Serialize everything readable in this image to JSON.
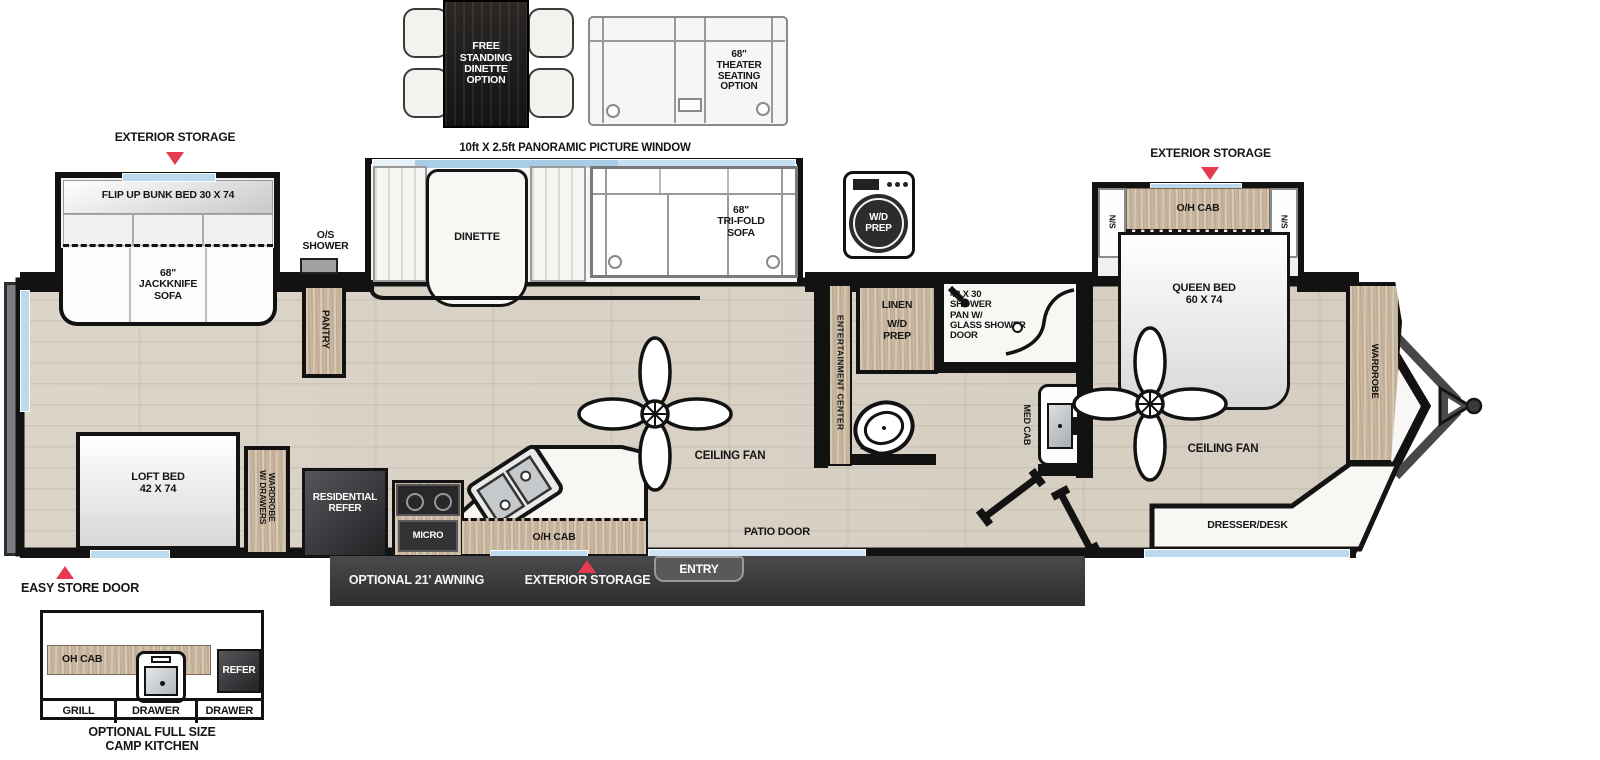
{
  "colors": {
    "accent_red": "#e63a50",
    "wall_black": "#121212",
    "window_blue": "#bcd9ee",
    "awning_bar": "#3c3c3f",
    "floor_wood": "#d9d2c5",
    "cabinet_wood": "#c8b59d"
  },
  "icons": {
    "washer": "washer-icon",
    "callout_marker": "triangle-marker",
    "fan": "ceiling-fan-icon",
    "hitch": "trailer-hitch-icon"
  },
  "top_options": {
    "dinette_label": "FREE\nSTANDING\nDINETTE\nOPTION",
    "theater_label": "68\"\nTHEATER\nSEATING\nOPTION",
    "window_label": "10ft X 2.5ft PANORAMIC PICTURE WINDOW",
    "washer_label": "W/D\nPREP"
  },
  "callouts": {
    "rear_storage": "EXTERIOR STORAGE",
    "front_storage": "EXTERIOR STORAGE",
    "bottom_storage": "EXTERIOR STORAGE",
    "easy_store": "EASY STORE DOOR",
    "awning": "OPTIONAL 21' AWNING",
    "entry": "ENTRY",
    "patio": "PATIO DOOR",
    "os_shower": "O/S\nSHOWER"
  },
  "living": {
    "bunk": "FLIP UP BUNK BED 30 X 74",
    "jackknife": "68\"\nJACKKNIFE\nSOFA",
    "dinette": "DINETTE",
    "trifold": "68\"\nTRI-FOLD\nSOFA",
    "pantry": "PANTRY",
    "fan": "CEILING FAN",
    "ent_center": "ENTERTAINMENT CENTER"
  },
  "kitchen": {
    "refer": "RESIDENTIAL\nREFER",
    "micro": "MICRO",
    "ohcab": "O/H CAB"
  },
  "bath": {
    "linen": "LINEN",
    "wd": "W/D\nPREP",
    "shower": "48 X 30\nSHOWER\nPAN W/\nGLASS SHOWER\nDOOR",
    "medcab": "MED CAB"
  },
  "bedroom": {
    "ohcab": "O/H CAB",
    "ns_l": "N/S",
    "ns_r": "N/S",
    "bed": "QUEEN BED\n60 X 74",
    "fan": "CEILING FAN",
    "wardrobe": "WARDROBE",
    "dresser": "DRESSER/DESK"
  },
  "rear": {
    "loft": "LOFT BED\n42 X 74",
    "wardrobe": "WARDROBE\nW/ DRAWERS"
  },
  "camp_kitchen": {
    "ohcab": "OH CAB",
    "refer": "REFER",
    "grill": "GRILL",
    "drawer_l": "DRAWER",
    "drawer_r": "DRAWER",
    "caption": "OPTIONAL FULL SIZE\nCAMP KITCHEN"
  }
}
